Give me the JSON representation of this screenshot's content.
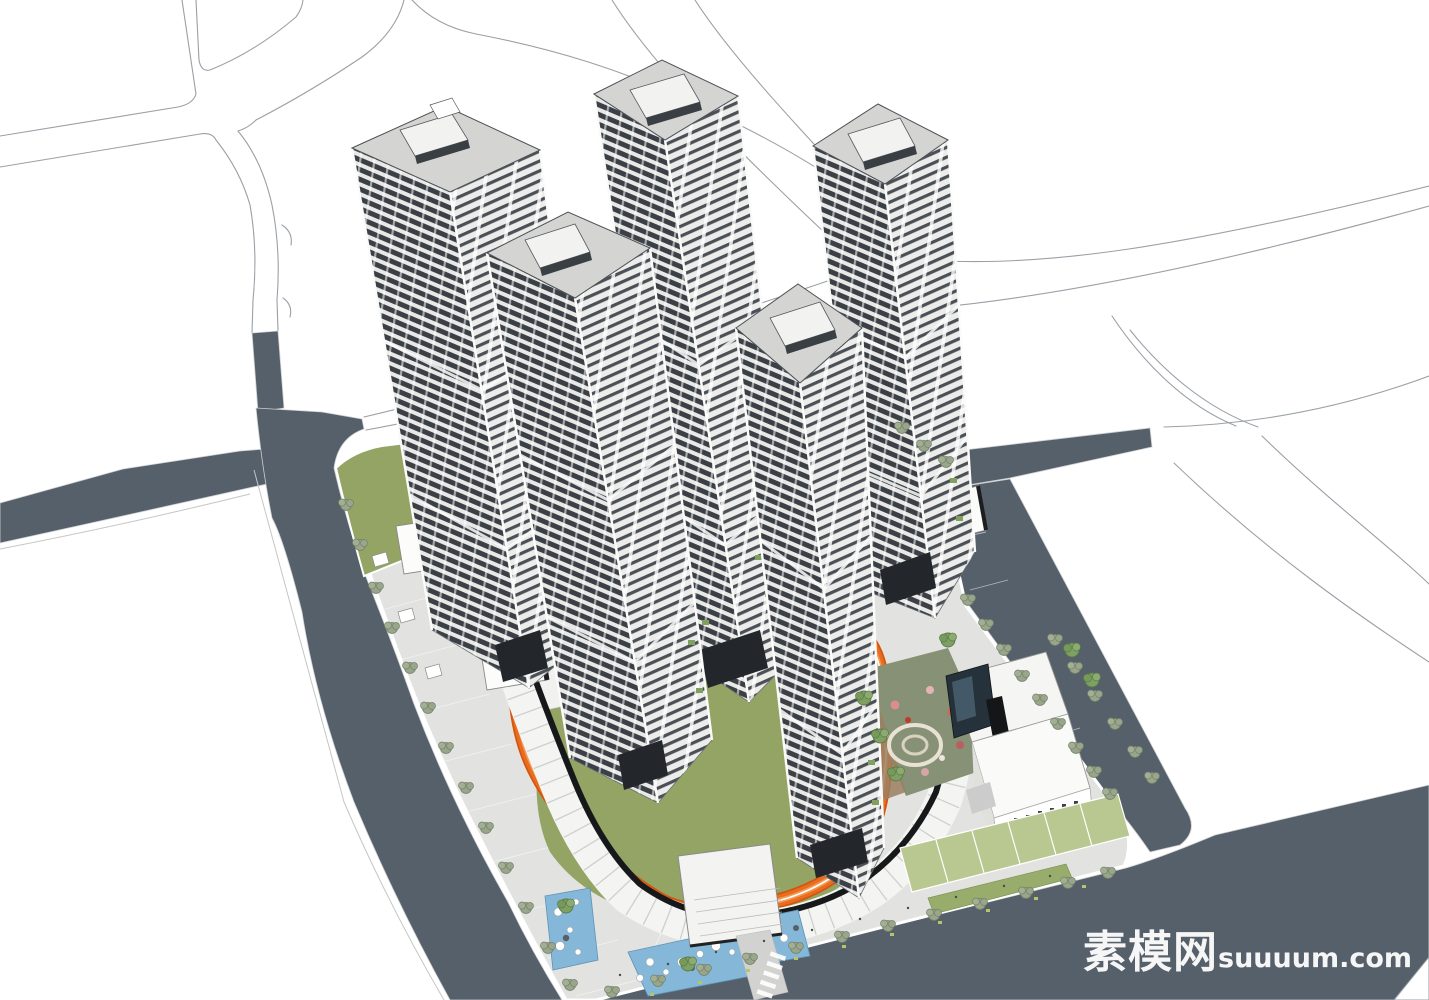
{
  "watermark": {
    "cn_text": "素模网",
    "latin_text": "suuuum.com"
  },
  "palette": {
    "background": "#ffffff",
    "road_fill": "#55606a",
    "outline_stroke": "#9aa0a6",
    "paving": "#e2e2e0",
    "lawn": "#93a464",
    "lawn_light": "#b9c890",
    "hedge": "#98ad6c",
    "playground_green": "#879175",
    "track_orange": "#ea6d1f",
    "track_edge": "#d4550e",
    "track_center": "#f29a55",
    "pool_blue": "#84b7d8",
    "tower_floor_dark": "#3a4046",
    "tower_floor_light": "#e8e8e6",
    "roof_gray": "#d4d5d3",
    "podium_black": "#17181a",
    "tree_green": "#9aa68b",
    "watermark_white": "#ffffff"
  }
}
